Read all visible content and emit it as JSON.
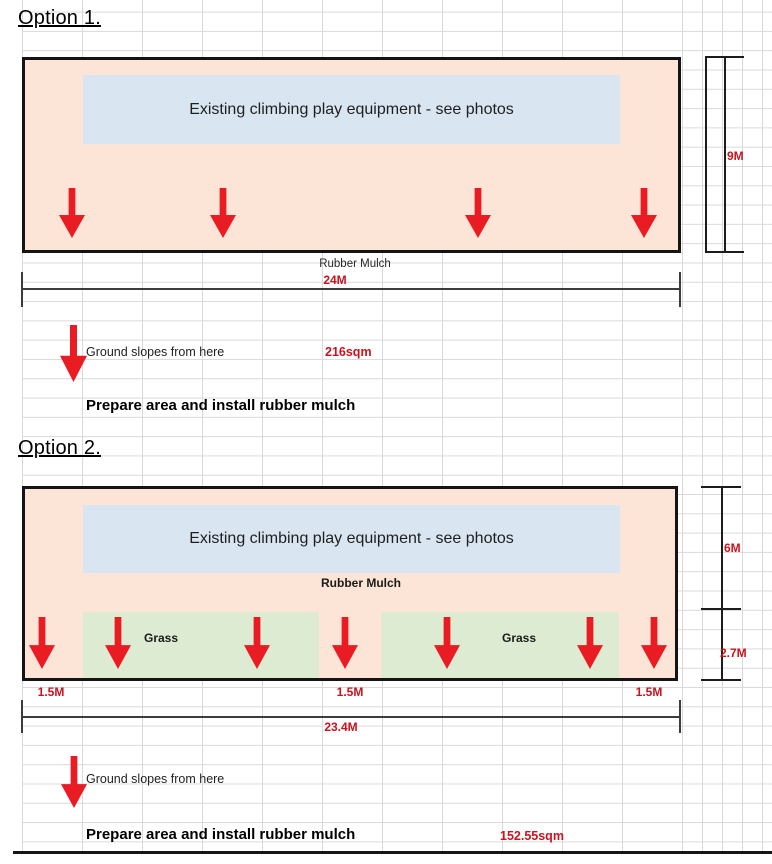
{
  "colors": {
    "mulch_fill": "#fce4d6",
    "equipment_fill": "#d9e5f1",
    "grass_fill": "#ddebd3",
    "dimension_red": "#c9131f",
    "arrow_red": "#e91b23"
  },
  "option1": {
    "title": "Option 1.",
    "equipment_label": "Existing climbing play equipment - see photos",
    "surface_label": "Rubber Mulch",
    "height_dim": "9M",
    "width_dim": "24M",
    "area": "216sqm",
    "slope_note": "Ground slopes from here",
    "caption": "Prepare area and install rubber mulch"
  },
  "option2": {
    "title": "Option 2.",
    "equipment_label": "Existing climbing play equipment - see photos",
    "surface_label": "Rubber Mulch",
    "grass_labels": [
      "Grass",
      "Grass"
    ],
    "height_dim_upper": "6M",
    "height_dim_lower": "2.7M",
    "edge_dims": [
      "1.5M",
      "1.5M",
      "1.5M"
    ],
    "width_dim": "23.4M",
    "area": "152.55sqm",
    "slope_note": "Ground slopes from here",
    "caption": "Prepare area and install rubber mulch"
  }
}
